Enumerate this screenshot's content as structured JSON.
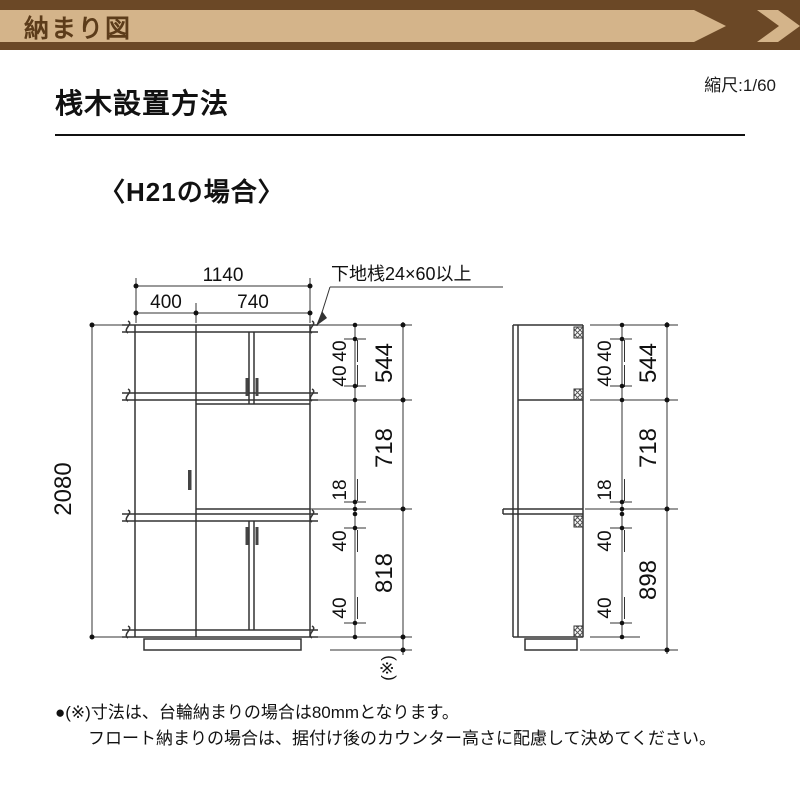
{
  "banner": {
    "title": "納まり図"
  },
  "header": {
    "scale_label": "縮尺:1/60",
    "heading": "桟木設置方法"
  },
  "section": {
    "subheading": "〈H21の場合〉"
  },
  "diagram": {
    "leader_label": "下地桟24×60以上",
    "front": {
      "total_width": "1140",
      "left_width": "400",
      "right_width": "740",
      "total_height": "2080",
      "rail_top": "40",
      "rail_upper_bottom": "40",
      "counter_thickness": "18",
      "rail_counter": "40",
      "rail_bottom": "40",
      "upper_height": "544",
      "middle_height": "718",
      "lower_height": "818",
      "floor_note": "(※)"
    },
    "side": {
      "rail_top": "40",
      "rail_upper_bottom": "40",
      "counter_thickness": "18",
      "rail_counter": "40",
      "rail_bottom": "40",
      "upper_height": "544",
      "middle_height": "718",
      "lower_height": "898"
    }
  },
  "note": {
    "line1": "●(※)寸法は、台輪納まりの場合は80mmとなります。",
    "line2": "フロート納まりの場合は、据付け後のカウンター高さに配慮して決めてください。"
  },
  "colors": {
    "brown_dark": "#6b4826",
    "tan": "#d4b48a",
    "banner_text": "#5c3c1a",
    "line": "#333333"
  }
}
